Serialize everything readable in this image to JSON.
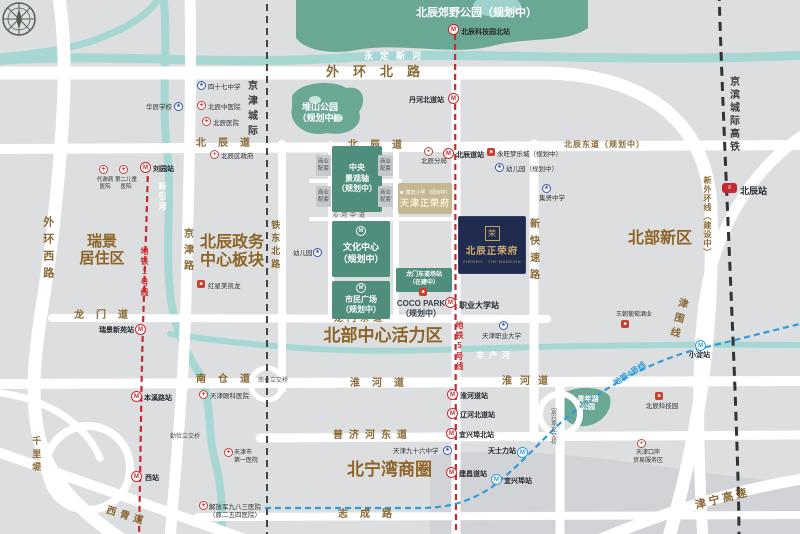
{
  "colors": {
    "accent_red": "#c8292f",
    "accent_blue": "#2f9cd8",
    "park_green": "#6ba795",
    "river_teal": "#a6d7d3",
    "road_brown": "#8a6a35",
    "navy_block": "#202c4d",
    "gold": "#d3ad6e",
    "planned_green": "#4f8d7d",
    "beige": "#c5b694"
  },
  "project": {
    "logo": "荣",
    "name": "北辰正荣府",
    "tagline": "ZHENRO · THE MANSION"
  },
  "sister_project": {
    "school": "★ 模范小学（规划中）",
    "name": "天津正荣府"
  },
  "labels": [
    {
      "id": "waihuan-beilu",
      "cls": "road",
      "x": 326,
      "y": 64,
      "t": "外环北路",
      "fs": 13,
      "ls": 14
    },
    {
      "id": "beichendao-w",
      "cls": "road",
      "x": 196,
      "y": 138,
      "t": "北辰道",
      "fs": 10,
      "ls": 12
    },
    {
      "id": "beichendao-c",
      "cls": "road",
      "x": 348,
      "y": 140,
      "t": "北辰道",
      "fs": 10,
      "ls": 12
    },
    {
      "id": "beichendongdao",
      "cls": "road",
      "x": 564,
      "y": 140,
      "t": "北辰东道（规划中）",
      "fs": 8,
      "ls": 1
    },
    {
      "id": "longmendao",
      "cls": "road",
      "x": 74,
      "y": 310,
      "t": "龙门道",
      "fs": 10,
      "ls": 12
    },
    {
      "id": "longmendongdao",
      "cls": "road",
      "x": 334,
      "y": 313,
      "t": "龙门东道",
      "fs": 9,
      "ls": 4
    },
    {
      "id": "huaihedao",
      "cls": "road",
      "x": 350,
      "y": 378,
      "t": "淮河道",
      "fs": 10,
      "ls": 12
    },
    {
      "id": "huaihedao2",
      "cls": "road",
      "x": 502,
      "y": 376,
      "t": "淮河道",
      "fs": 10,
      "ls": 8
    },
    {
      "id": "nancangdao",
      "cls": "road",
      "x": 196,
      "y": 374,
      "t": "南仓道",
      "fs": 10,
      "ls": 12
    },
    {
      "id": "pujihedongdao",
      "cls": "road",
      "x": 333,
      "y": 430,
      "t": "普济河东道",
      "fs": 10,
      "ls": 6
    },
    {
      "id": "zhichenglu",
      "cls": "road",
      "x": 338,
      "y": 509,
      "t": "志成路",
      "fs": 10,
      "ls": 12
    },
    {
      "id": "xiqingdao",
      "cls": "road",
      "x": 108,
      "y": 505,
      "t": "西青道",
      "fs": 10,
      "ls": 4,
      "rot": 17
    },
    {
      "id": "jinning-gaosu",
      "cls": "road",
      "x": 694,
      "y": 500,
      "t": "津宁高速",
      "fs": 11,
      "ls": 3,
      "rot": -14
    },
    {
      "id": "qinhebeidao",
      "cls": "tiny",
      "x": 332,
      "y": 175,
      "t": "沁河北道",
      "fs": 6,
      "ls": 3
    },
    {
      "id": "qinhezhongdao",
      "cls": "tiny",
      "x": 332,
      "y": 213,
      "t": "沁河中道",
      "fs": 6,
      "ls": 3
    },
    {
      "id": "nancang-lijiao",
      "cls": "tiny",
      "x": 258,
      "y": 378,
      "t": "南仓立交桥",
      "fs": 6
    },
    {
      "id": "qinjian-lijiao",
      "cls": "tiny",
      "x": 170,
      "y": 434,
      "t": "勤俭立交桥",
      "fs": 6
    },
    {
      "id": "waihuanxilu",
      "cls": "road-v",
      "x": 40,
      "y": 216,
      "t": "外环西路",
      "fs": 11,
      "ls": 6
    },
    {
      "id": "jingjinlu",
      "cls": "road-v",
      "x": 180,
      "y": 228,
      "t": "京津路",
      "fs": 10,
      "ls": 6
    },
    {
      "id": "tiedongbeilu",
      "cls": "road-v",
      "x": 269,
      "y": 220,
      "t": "铁东北路",
      "fs": 9,
      "ls": 4
    },
    {
      "id": "xinkuaisulu",
      "cls": "road-v",
      "x": 526,
      "y": 218,
      "t": "新快速路",
      "fs": 10,
      "ls": 7
    },
    {
      "id": "qianliti",
      "cls": "road-v",
      "x": 30,
      "y": 436,
      "t": "千里堤",
      "fs": 9,
      "ls": 4
    },
    {
      "id": "jinweixian",
      "cls": "road-v",
      "x": 676,
      "y": 296,
      "t": "津围线",
      "fs": 10,
      "ls": 5,
      "rot": 15
    },
    {
      "id": "xinwaihuan",
      "cls": "road-v",
      "x": 702,
      "y": 176,
      "t": "新外环线（建设中）",
      "fs": 8,
      "ls": 1
    },
    {
      "id": "yixingbu-lijiao",
      "cls": "tiny-v",
      "x": 548,
      "y": 408,
      "t": "宜兴埠立交桥",
      "fs": 6
    },
    {
      "id": "jingjin-chengji",
      "cls": "rail-v",
      "x": 244,
      "y": 80,
      "t": "京津城际",
      "fs": 10,
      "ls": 5
    },
    {
      "id": "jingbin-gaotie",
      "cls": "rail-v",
      "x": 726,
      "y": 76,
      "t": "京滨城际高铁",
      "fs": 10,
      "ls": 3
    },
    {
      "id": "line1",
      "cls": "metro-red-v",
      "x": 139,
      "y": 247,
      "t": "地铁1号线",
      "fs": 8,
      "ls": 2
    },
    {
      "id": "line5",
      "cls": "metro-red-v",
      "x": 454,
      "y": 321,
      "t": "地铁5号线",
      "fs": 8,
      "ls": 2
    },
    {
      "id": "line4",
      "cls": "metro-blue",
      "x": 612,
      "y": 380,
      "t": "地铁4号线",
      "fs": 8,
      "rot": -33
    },
    {
      "id": "yongdingxinhe",
      "cls": "river",
      "x": 364,
      "y": 51,
      "t": "永定新河",
      "fs": 9,
      "ls": 7
    },
    {
      "id": "xinyinhe",
      "cls": "river-v",
      "x": 157,
      "y": 182,
      "t": "新引河",
      "fs": 8,
      "ls": 2
    },
    {
      "id": "fengchanhe",
      "cls": "river",
      "x": 476,
      "y": 351,
      "t": "丰产河",
      "fs": 8,
      "ls": 5
    },
    {
      "id": "ruijing",
      "cls": "district",
      "x": 72,
      "y": 233,
      "w": 60,
      "t": "瑞景\n居住区",
      "fs": 15
    },
    {
      "id": "zhengwu-bankuai",
      "cls": "district",
      "x": 192,
      "y": 234,
      "w": 80,
      "t": "北辰政务\n中心板块",
      "fs": 16
    },
    {
      "id": "huoli-qu",
      "cls": "district",
      "x": 308,
      "y": 326,
      "w": 150,
      "t": "北部中心活力区",
      "fs": 17
    },
    {
      "id": "beibu-xinqu",
      "cls": "district",
      "x": 620,
      "y": 230,
      "w": 80,
      "t": "北部新区",
      "fs": 16
    },
    {
      "id": "beiningwan",
      "cls": "district",
      "x": 342,
      "y": 460,
      "w": 95,
      "t": "北宁湾商圈",
      "fs": 17
    },
    {
      "id": "jiaoye-park",
      "cls": "park",
      "x": 416,
      "y": 7,
      "w": 120,
      "t": "北辰郊野公园（规划中）",
      "fs": 11
    },
    {
      "id": "duishan-park",
      "cls": "park",
      "x": 292,
      "y": 102,
      "w": 56,
      "t": "堆山公园\n（规划中）",
      "fs": 9
    },
    {
      "id": "qingnianhu-park",
      "cls": "park",
      "x": 566,
      "y": 396,
      "w": 44,
      "t": "青年湖\n公园",
      "fs": 7
    },
    {
      "id": "zhongyang-zhou",
      "cls": "gblock",
      "x": 332,
      "y": 146,
      "w": 50,
      "h": 66,
      "t": "中央\n景观轴\n（规划中）",
      "fs": 8
    },
    {
      "id": "wenhua-zhongxin",
      "cls": "gblock gb-pad",
      "x": 332,
      "y": 221,
      "w": 58,
      "h": 56,
      "t": "文化中心\n（规划中）",
      "fs": 9
    },
    {
      "id": "shimin-guangchang",
      "cls": "gblock gb-pad",
      "x": 332,
      "y": 281,
      "w": 58,
      "h": 38,
      "t": "市民广场\n（规划中）",
      "fs": 8
    },
    {
      "id": "longmen-changzhan",
      "cls": "gblock",
      "x": 396,
      "y": 268,
      "w": 56,
      "h": 24,
      "t": "龙门东道场站\n（在建中）",
      "fs": 6
    },
    {
      "id": "biz1",
      "cls": "bizbox",
      "x": 316,
      "y": 155,
      "w": 15,
      "h": 21,
      "t": "商业\n配套",
      "fs": 5.5
    },
    {
      "id": "biz2",
      "cls": "bizbox",
      "x": 378,
      "y": 155,
      "w": 15,
      "h": 21,
      "t": "商业\n配套",
      "fs": 5.5
    },
    {
      "id": "biz3",
      "cls": "bizbox",
      "x": 316,
      "y": 186,
      "w": 15,
      "h": 21,
      "t": "商业\n配套",
      "fs": 5.5
    },
    {
      "id": "biz4",
      "cls": "bizbox",
      "x": 378,
      "y": 186,
      "w": 15,
      "h": 21,
      "t": "商业\n配套",
      "fs": 5.5
    },
    {
      "id": "st-kejiyuan-bei",
      "cls": "st",
      "x": 461,
      "y": 29,
      "t": "北辰科技园北站",
      "fs": 7
    },
    {
      "id": "st-danhebeidao",
      "cls": "st",
      "x": 409,
      "y": 97,
      "t": "丹河北道站",
      "fs": 7
    },
    {
      "id": "st-beichendao",
      "cls": "st",
      "x": 456,
      "y": 152,
      "t": "北辰道站",
      "fs": 7
    },
    {
      "id": "st-liuyuan",
      "cls": "st",
      "x": 153,
      "y": 166,
      "t": "刘园站",
      "fs": 7
    },
    {
      "id": "st-ruijingxinyuan",
      "cls": "st",
      "x": 99,
      "y": 327,
      "t": "瑞景新苑站",
      "fs": 7
    },
    {
      "id": "st-benxilu",
      "cls": "st",
      "x": 144,
      "y": 395,
      "t": "本溪路站",
      "fs": 7
    },
    {
      "id": "st-xizhan",
      "cls": "st",
      "x": 145,
      "y": 475,
      "t": "西站",
      "fs": 7
    },
    {
      "id": "st-zhiyedaxue",
      "cls": "st",
      "x": 459,
      "y": 301,
      "t": "职业大学站",
      "fs": 8
    },
    {
      "id": "st-huaihedao",
      "cls": "st",
      "x": 460,
      "y": 393,
      "t": "淮河道站",
      "fs": 7
    },
    {
      "id": "st-liaohebeidao",
      "cls": "st",
      "x": 460,
      "y": 412,
      "t": "辽河北道站",
      "fs": 7
    },
    {
      "id": "st-yixingbubei",
      "cls": "st",
      "x": 459,
      "y": 432,
      "t": "宜兴埠北站",
      "fs": 7
    },
    {
      "id": "st-jianchangdao",
      "cls": "st",
      "x": 459,
      "y": 471,
      "t": "建昌道站",
      "fs": 7
    },
    {
      "id": "st-tianshili",
      "cls": "st",
      "x": 488,
      "y": 448,
      "t": "天士力站",
      "fs": 7
    },
    {
      "id": "st-yixingbu",
      "cls": "st",
      "x": 504,
      "y": 478,
      "t": "宜兴埠站",
      "fs": 7
    },
    {
      "id": "st-xiaodian",
      "cls": "st",
      "x": 689,
      "y": 352,
      "t": "小淀站",
      "fs": 7
    },
    {
      "id": "st-beichen",
      "cls": "st",
      "x": 740,
      "y": 186,
      "t": "北辰站",
      "fs": 9
    },
    {
      "id": "poi-47-middle",
      "cls": "poi",
      "x": 208,
      "y": 84,
      "t": "四十七中学",
      "fs": 6.5
    },
    {
      "id": "poi-huachen-school",
      "cls": "poi",
      "x": 146,
      "y": 104,
      "t": "华辰学校",
      "fs": 6.5
    },
    {
      "id": "poi-zhongyi-hosp",
      "cls": "poi",
      "x": 208,
      "y": 104,
      "t": "北辰中医院",
      "fs": 6.5
    },
    {
      "id": "poi-beichen-hosp",
      "cls": "poi",
      "x": 213,
      "y": 120,
      "t": "北辰医院",
      "fs": 6.5
    },
    {
      "id": "poi-qu-gov",
      "cls": "poi",
      "x": 221,
      "y": 153,
      "t": "北辰区政府",
      "fs": 6.5
    },
    {
      "id": "poi-hongxing",
      "cls": "poi",
      "x": 208,
      "y": 283,
      "t": "红星美凯龙",
      "fs": 6.5
    },
    {
      "id": "poi-youeryuan-w",
      "cls": "poi",
      "x": 293,
      "y": 250,
      "t": "幼儿园",
      "fs": 6.5
    },
    {
      "id": "poi-daxiebing",
      "cls": "poi ctr",
      "x": 92,
      "y": 177,
      "w": 26,
      "t": "代谢病\n医院",
      "fs": 5.5
    },
    {
      "id": "poi-er-ertong",
      "cls": "poi ctr",
      "x": 112,
      "y": 177,
      "w": 28,
      "t": "第二儿童\n医院",
      "fs": 5.5
    },
    {
      "id": "poi-fenju",
      "cls": "poi ctr",
      "x": 414,
      "y": 158,
      "w": 40,
      "t": "北辰分局",
      "fs": 6.5
    },
    {
      "id": "poi-yongwang",
      "cls": "poi",
      "x": 497,
      "y": 151,
      "t": "永旺梦乐城（规划中）",
      "fs": 6.5
    },
    {
      "id": "poi-youeryuan-e",
      "cls": "poi",
      "x": 506,
      "y": 166,
      "t": "幼儿园（规划中）",
      "fs": 6.5
    },
    {
      "id": "poi-jixian",
      "cls": "poi ctr",
      "x": 530,
      "y": 195,
      "w": 44,
      "t": "集贤中学",
      "fs": 6.5
    },
    {
      "id": "poi-zhiye-univ",
      "cls": "poi",
      "x": 482,
      "y": 333,
      "t": "天津职业大学",
      "fs": 6.5
    },
    {
      "id": "poi-yanke",
      "cls": "poi",
      "x": 210,
      "y": 393,
      "t": "天津眼科医院",
      "fs": 6.5
    },
    {
      "id": "poi-diyi-hosp",
      "cls": "poi",
      "x": 234,
      "y": 450,
      "t": "天津市\n第一医院",
      "fs": 6
    },
    {
      "id": "poi-983",
      "cls": "poi",
      "x": 209,
      "y": 504,
      "t": "解放军九八三医院\n（原二五四医院）",
      "fs": 6.5
    },
    {
      "id": "poi-96-middle",
      "cls": "poi",
      "x": 393,
      "y": 448,
      "t": "天津九十六中学",
      "fs": 6.5
    },
    {
      "id": "poi-wangchao",
      "cls": "poi",
      "x": 616,
      "y": 312,
      "t": "王朝葡萄酒业",
      "fs": 6
    },
    {
      "id": "poi-kejiyuan",
      "cls": "poi ctr",
      "x": 640,
      "y": 403,
      "w": 44,
      "t": "北辰科技园",
      "fs": 6.5
    },
    {
      "id": "poi-kouan",
      "cls": "poi ctr",
      "x": 622,
      "y": 450,
      "w": 52,
      "t": "天津口岸\n贸易服务区",
      "fs": 6
    },
    {
      "id": "coco-park",
      "cls": "coco",
      "x": 394,
      "y": 299,
      "w": 54,
      "t": "COCO PARK\n（规划中）",
      "fs": 8
    }
  ],
  "icons": [
    {
      "cls": "mred",
      "x": 448,
      "y": 24
    },
    {
      "cls": "mred",
      "x": 448,
      "y": 93
    },
    {
      "cls": "mred",
      "x": 443,
      "y": 148
    },
    {
      "cls": "mred",
      "x": 140,
      "y": 162
    },
    {
      "cls": "mred",
      "x": 135,
      "y": 324
    },
    {
      "cls": "mred",
      "x": 131,
      "y": 391
    },
    {
      "cls": "mred",
      "x": 131,
      "y": 471
    },
    {
      "cls": "mred",
      "x": 445,
      "y": 297
    },
    {
      "cls": "mred",
      "x": 447,
      "y": 389
    },
    {
      "cls": "mred",
      "x": 447,
      "y": 408
    },
    {
      "cls": "mred",
      "x": 446,
      "y": 428
    },
    {
      "cls": "mred",
      "x": 446,
      "y": 467
    },
    {
      "cls": "mblue",
      "x": 517,
      "y": 447
    },
    {
      "cls": "mblue",
      "x": 491,
      "y": 474
    },
    {
      "cls": "mblue",
      "x": 695,
      "y": 340
    },
    {
      "cls": "mgreen",
      "x": 356,
      "y": 226
    },
    {
      "cls": "mgreen",
      "x": 356,
      "y": 283
    },
    {
      "cls": "rail",
      "x": 722,
      "y": 183
    },
    {
      "cls": "hosp",
      "x": 197,
      "y": 101
    },
    {
      "cls": "hosp",
      "x": 202,
      "y": 117
    },
    {
      "cls": "hosp",
      "x": 99,
      "y": 165
    },
    {
      "cls": "hosp",
      "x": 119,
      "y": 165
    },
    {
      "cls": "hosp",
      "x": 199,
      "y": 390
    },
    {
      "cls": "hosp",
      "x": 224,
      "y": 448
    },
    {
      "cls": "hosp",
      "x": 199,
      "y": 501
    },
    {
      "cls": "school",
      "x": 197,
      "y": 81
    },
    {
      "cls": "school",
      "x": 174,
      "y": 102
    },
    {
      "cls": "school",
      "x": 313,
      "y": 248
    },
    {
      "cls": "school",
      "x": 495,
      "y": 163
    },
    {
      "cls": "school",
      "x": 542,
      "y": 184
    },
    {
      "cls": "school",
      "x": 499,
      "y": 321
    },
    {
      "cls": "school",
      "x": 443,
      "y": 446
    },
    {
      "cls": "gov",
      "x": 210,
      "y": 150
    },
    {
      "cls": "gov",
      "x": 424,
      "y": 147
    },
    {
      "cls": "gov",
      "x": 637,
      "y": 439
    },
    {
      "cls": "shop",
      "x": 197,
      "y": 280
    },
    {
      "cls": "shop",
      "x": 487,
      "y": 148
    },
    {
      "cls": "shop",
      "x": 419,
      "y": 288
    },
    {
      "cls": "shop",
      "x": 621,
      "y": 320
    },
    {
      "cls": "shop",
      "x": 655,
      "y": 392
    }
  ]
}
